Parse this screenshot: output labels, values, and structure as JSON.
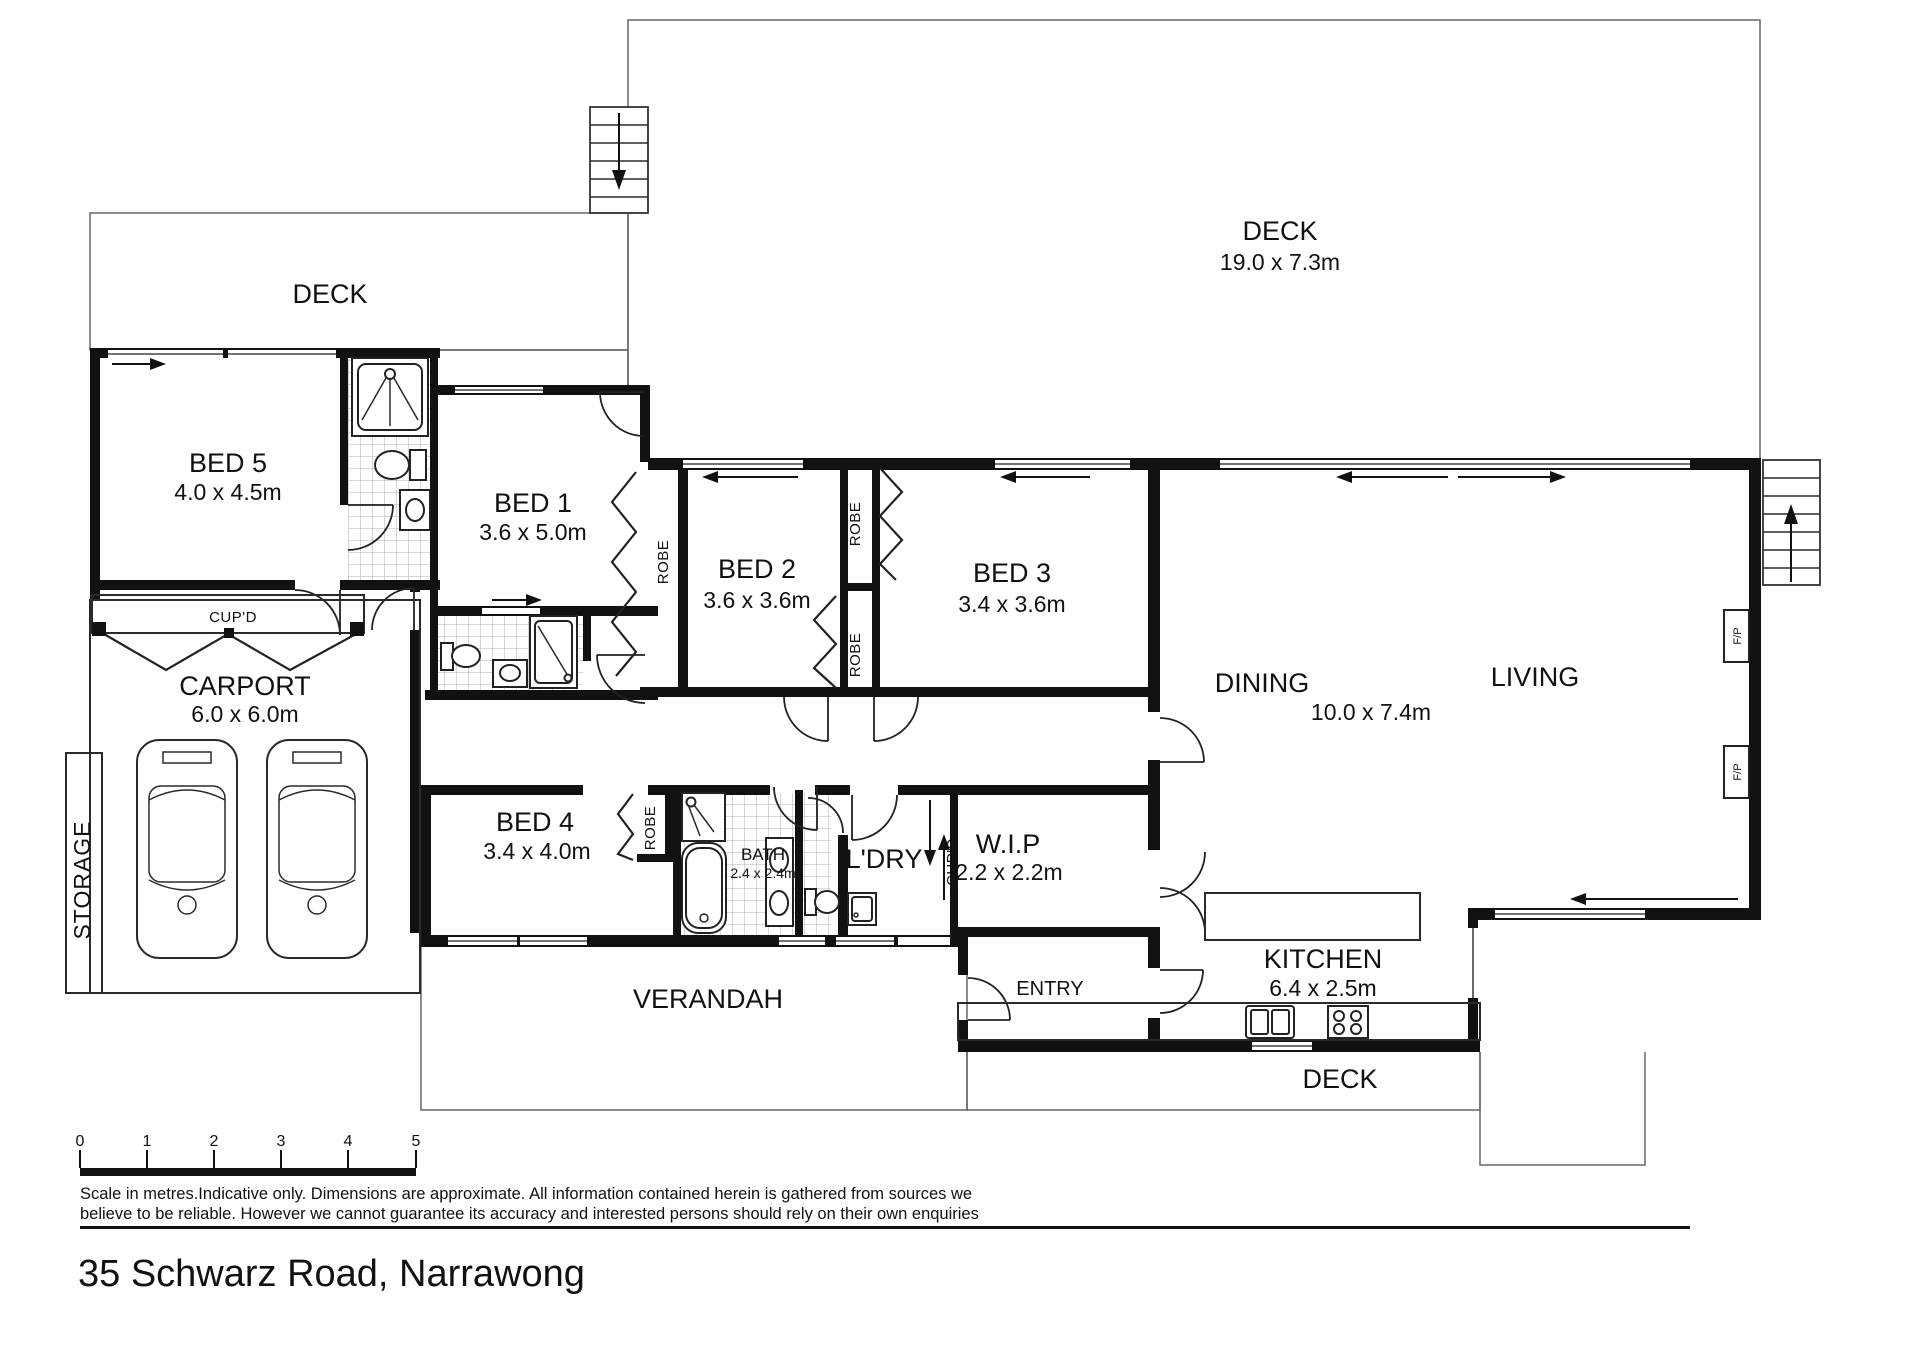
{
  "rooms": {
    "deck_left": {
      "name": "DECK"
    },
    "deck_main": {
      "name": "DECK",
      "dims": "19.0 x 7.3m"
    },
    "bed5": {
      "name": "BED 5",
      "dims": "4.0 x 4.5m"
    },
    "bed1": {
      "name": "BED 1",
      "dims": "3.6 x 5.0m"
    },
    "bed2": {
      "name": "BED 2",
      "dims": "3.6 x 3.6m"
    },
    "bed3": {
      "name": "BED 3",
      "dims": "3.4 x 3.6m"
    },
    "dining": {
      "name": "DINING"
    },
    "living": {
      "name": "LIVING"
    },
    "living_dining_dims": "10.0 x 7.4m",
    "carport": {
      "name": "CARPORT",
      "dims": "6.0 x 6.0m"
    },
    "bed4": {
      "name": "BED 4",
      "dims": "3.4 x 4.0m"
    },
    "bath": {
      "name": "BATH",
      "dims": "2.4 x 2.4m"
    },
    "ldry": {
      "name": "L'DRY"
    },
    "wip": {
      "name": "W.I.P",
      "dims": "2.2 x 2.2m"
    },
    "kitchen": {
      "name": "KITCHEN",
      "dims": "6.4 x 2.5m"
    },
    "entry": {
      "name": "ENTRY"
    },
    "verandah": {
      "name": "VERANDAH"
    },
    "deck_bottom": {
      "name": "DECK"
    },
    "storage": {
      "name": "STORAGE"
    }
  },
  "labels": {
    "cupd": "CUP'D",
    "robe": "ROBE",
    "fp": "F/P"
  },
  "footer": {
    "scale_ticks": [
      "0",
      "1",
      "2",
      "3",
      "4",
      "5"
    ],
    "disclaimer_line1": "Scale in metres.Indicative only.  Dimensions are approximate.  All information contained herein is gathered from sources we",
    "disclaimer_line2": "believe to be reliable.  However we cannot guarantee its accuracy and interested persons should rely on their own enquiries",
    "address": "35 Schwarz Road, Narrawong"
  },
  "colors": {
    "wall": "#111111",
    "deck_hatch": "#b0b0b0",
    "tile": "#b8b8b8",
    "paper": "#ffffff"
  }
}
